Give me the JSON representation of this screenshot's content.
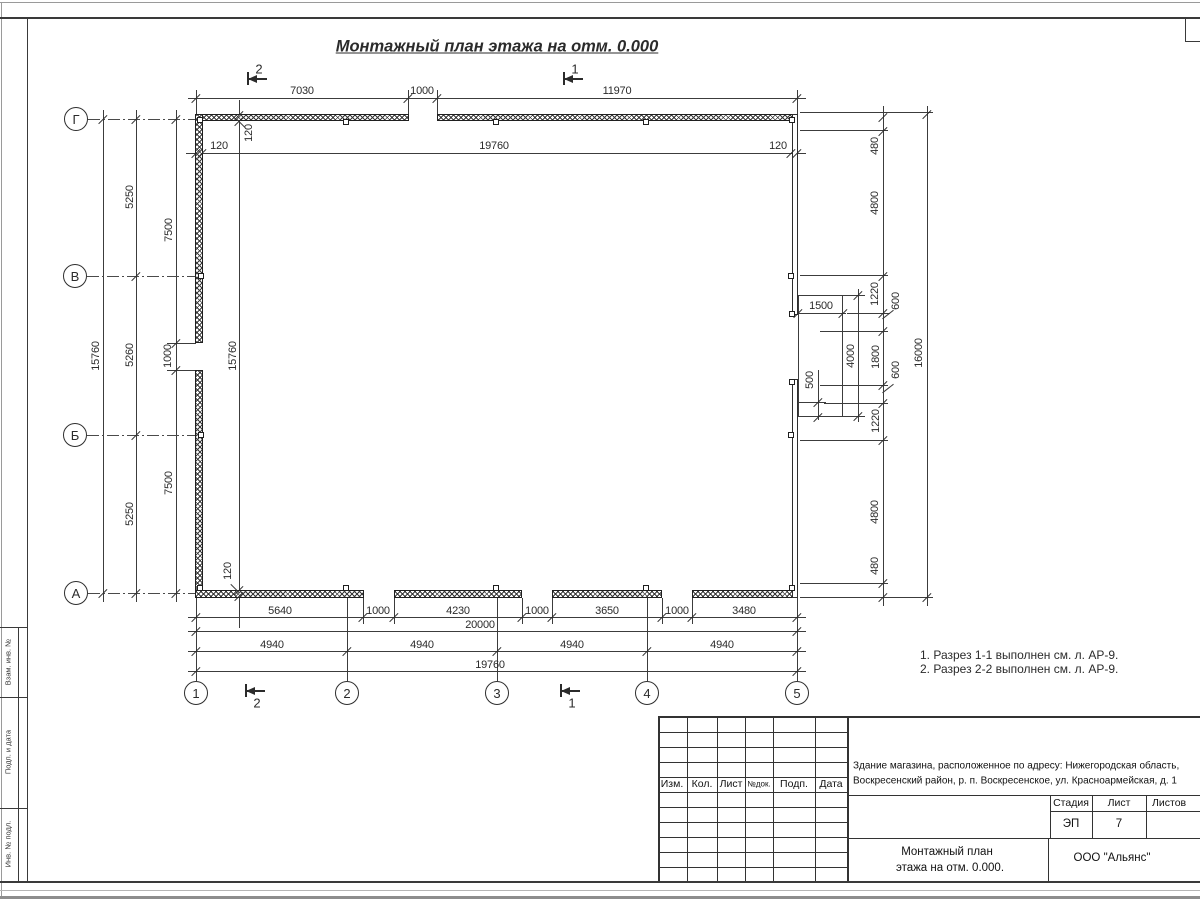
{
  "page": {
    "title": "Монтажный план этажа на отм. 0.000",
    "notes": [
      "1. Разрез 1-1 выполнен см. л. АР-9.",
      "2. Разрез 2-2 выполнен см. л. АР-9."
    ]
  },
  "colors": {
    "line": "#3c3c3c",
    "wall": "#1f1f1f",
    "text": "#2b2b2b"
  },
  "frame": {
    "side_labels": [
      "Взам. инв. №",
      "Подп. и дата",
      "Инв. № подл."
    ]
  },
  "axes": {
    "left": [
      {
        "label": "Г",
        "cx": 76,
        "cy": 119
      },
      {
        "label": "В",
        "cx": 75,
        "cy": 276
      },
      {
        "label": "Б",
        "cx": 75,
        "cy": 435
      },
      {
        "label": "А",
        "cx": 76,
        "cy": 593
      }
    ],
    "bottom": [
      {
        "label": "1",
        "cx": 196,
        "cy": 693
      },
      {
        "label": "2",
        "cx": 347,
        "cy": 693
      },
      {
        "label": "3",
        "cx": 497,
        "cy": 693
      },
      {
        "label": "4",
        "cx": 647,
        "cy": 693
      },
      {
        "label": "5",
        "cx": 797,
        "cy": 693
      }
    ]
  },
  "section_markers": [
    {
      "label": "2",
      "x": 247,
      "y": 78,
      "pos": "top"
    },
    {
      "label": "1",
      "x": 563,
      "y": 78,
      "pos": "top"
    },
    {
      "label": "2",
      "x": 245,
      "y": 690,
      "pos": "bottom"
    },
    {
      "label": "1",
      "x": 560,
      "y": 690,
      "pos": "bottom"
    }
  ],
  "drawing": {
    "walls": [
      [
        195,
        114,
        214,
        7
      ],
      [
        437,
        114,
        361,
        7
      ],
      [
        195,
        114,
        8,
        229
      ],
      [
        195,
        370,
        8,
        228
      ],
      [
        195,
        590,
        169,
        8
      ],
      [
        394,
        590,
        128,
        8
      ],
      [
        552,
        590,
        110,
        8
      ],
      [
        692,
        590,
        106,
        8
      ]
    ],
    "curtain_walls": [
      [
        792,
        114,
        6,
        201
      ],
      [
        792,
        379,
        6,
        219
      ]
    ],
    "porch": [
      798,
      295,
      45,
      122
    ],
    "columns": [
      [
        197,
        117
      ],
      [
        343,
        119
      ],
      [
        493,
        119
      ],
      [
        643,
        119
      ],
      [
        789,
        117
      ],
      [
        197,
        585
      ],
      [
        343,
        585
      ],
      [
        493,
        585
      ],
      [
        643,
        585
      ],
      [
        789,
        585
      ],
      [
        198,
        273
      ],
      [
        198,
        432
      ],
      [
        788,
        273
      ],
      [
        789,
        311
      ],
      [
        789,
        379
      ],
      [
        788,
        432
      ]
    ],
    "lines": [
      [
        0,
        2,
        1200,
        1,
        "#9a9a9a"
      ],
      [
        1,
        2,
        1,
        895,
        "#9a9a9a"
      ],
      [
        0,
        17,
        1200,
        2,
        "#3a3a3a"
      ],
      [
        27,
        17,
        1,
        864,
        "#3a3a3a"
      ],
      [
        18,
        627,
        1,
        254,
        "#3a3a3a"
      ],
      [
        0,
        627,
        27,
        1,
        "#3a3a3a"
      ],
      [
        0,
        697,
        27,
        1,
        "#3a3a3a"
      ],
      [
        0,
        808,
        27,
        1,
        "#3a3a3a"
      ],
      [
        0,
        881,
        1200,
        2,
        "#3a3a3a"
      ],
      [
        0,
        890,
        1200,
        1,
        "#b5b5b5"
      ],
      [
        0,
        896,
        1200,
        3,
        "#8d8d8d"
      ],
      [
        1185,
        18,
        1,
        24,
        "#3a3a3a"
      ],
      [
        1185,
        41,
        15,
        1,
        "#3a3a3a"
      ],
      [
        658,
        716,
        542,
        2,
        "#333"
      ],
      [
        658,
        732,
        189,
        1,
        "#333"
      ],
      [
        658,
        747,
        189,
        1,
        "#333"
      ],
      [
        658,
        762,
        189,
        1,
        "#333"
      ],
      [
        658,
        777,
        189,
        1,
        "#333"
      ],
      [
        658,
        792,
        189,
        1,
        "#333"
      ],
      [
        658,
        807,
        189,
        1,
        "#333"
      ],
      [
        658,
        822,
        189,
        1,
        "#333"
      ],
      [
        658,
        837,
        189,
        1,
        "#333"
      ],
      [
        658,
        852,
        189,
        1,
        "#333"
      ],
      [
        658,
        867,
        189,
        1,
        "#333"
      ],
      [
        658,
        716,
        2,
        165,
        "#333"
      ],
      [
        687,
        717,
        1,
        164,
        "#333"
      ],
      [
        717,
        717,
        1,
        164,
        "#333"
      ],
      [
        745,
        717,
        1,
        164,
        "#333"
      ],
      [
        773,
        717,
        1,
        164,
        "#333"
      ],
      [
        815,
        717,
        1,
        164,
        "#333"
      ],
      [
        847,
        716,
        2,
        165,
        "#333"
      ],
      [
        847,
        795,
        353,
        1,
        "#333"
      ],
      [
        1050,
        811,
        150,
        1,
        "#333"
      ],
      [
        847,
        838,
        353,
        1,
        "#333"
      ],
      [
        1050,
        795,
        1,
        43,
        "#333"
      ],
      [
        1092,
        795,
        1,
        43,
        "#333"
      ],
      [
        1146,
        795,
        1,
        43,
        "#333"
      ],
      [
        1048,
        838,
        1,
        43,
        "#333"
      ],
      [
        188,
        98,
        618,
        1
      ],
      [
        186,
        153,
        620,
        1
      ],
      [
        167,
        343,
        29,
        1
      ],
      [
        167,
        370,
        29,
        1
      ],
      [
        188,
        617,
        618,
        1
      ],
      [
        188,
        631,
        618,
        1
      ],
      [
        188,
        651,
        618,
        1
      ],
      [
        188,
        671,
        618,
        1
      ],
      [
        800,
        112,
        133,
        1
      ],
      [
        800,
        130,
        88,
        1
      ],
      [
        800,
        275,
        88,
        1
      ],
      [
        847,
        313,
        43,
        1
      ],
      [
        820,
        331,
        68,
        1
      ],
      [
        820,
        385,
        68,
        1
      ],
      [
        824,
        403,
        64,
        1
      ],
      [
        800,
        440,
        88,
        1
      ],
      [
        800,
        583,
        88,
        1
      ],
      [
        800,
        597,
        133,
        1
      ],
      [
        795,
        313,
        51,
        1
      ],
      [
        843,
        295,
        22,
        1
      ],
      [
        843,
        416,
        22,
        1
      ],
      [
        798,
        402,
        28,
        1
      ],
      [
        103,
        110,
        1,
        492
      ],
      [
        136,
        110,
        1,
        492
      ],
      [
        176,
        110,
        1,
        492
      ],
      [
        239,
        100,
        1,
        528
      ],
      [
        196,
        90,
        1,
        25
      ],
      [
        408,
        90,
        1,
        25
      ],
      [
        437,
        90,
        1,
        25
      ],
      [
        797,
        90,
        1,
        25
      ],
      [
        883,
        106,
        1,
        500
      ],
      [
        927,
        106,
        1,
        500
      ],
      [
        196,
        598,
        1,
        83
      ],
      [
        347,
        598,
        1,
        83
      ],
      [
        497,
        598,
        1,
        83
      ],
      [
        647,
        598,
        1,
        83
      ],
      [
        797,
        598,
        1,
        83
      ],
      [
        363,
        598,
        1,
        26
      ],
      [
        394,
        598,
        1,
        26
      ],
      [
        522,
        598,
        1,
        26
      ],
      [
        552,
        598,
        1,
        26
      ],
      [
        662,
        598,
        1,
        26
      ],
      [
        692,
        598,
        1,
        26
      ],
      [
        858,
        289,
        1,
        133
      ],
      [
        818,
        370,
        1,
        50
      ]
    ],
    "axis_dashes": [
      [
        88,
        119,
        107
      ],
      [
        87,
        276,
        108
      ],
      [
        87,
        435,
        108
      ],
      [
        88,
        593,
        107
      ]
    ],
    "ticks": [
      [
        196,
        98
      ],
      [
        408,
        98
      ],
      [
        437,
        98
      ],
      [
        797,
        98
      ],
      [
        196,
        153
      ],
      [
        202,
        153
      ],
      [
        791,
        153
      ],
      [
        797,
        153
      ],
      [
        103,
        119
      ],
      [
        103,
        593
      ],
      [
        136,
        119
      ],
      [
        136,
        276
      ],
      [
        136,
        435
      ],
      [
        136,
        593
      ],
      [
        176,
        119
      ],
      [
        176,
        343
      ],
      [
        176,
        370
      ],
      [
        176,
        593
      ],
      [
        239,
        115
      ],
      [
        239,
        121
      ],
      [
        239,
        590
      ],
      [
        239,
        596
      ],
      [
        883,
        117
      ],
      [
        883,
        131
      ],
      [
        883,
        276
      ],
      [
        883,
        313
      ],
      [
        883,
        331
      ],
      [
        883,
        385
      ],
      [
        883,
        403
      ],
      [
        883,
        440
      ],
      [
        883,
        583
      ],
      [
        883,
        597
      ],
      [
        927,
        114
      ],
      [
        927,
        597
      ],
      [
        196,
        617
      ],
      [
        363,
        617
      ],
      [
        394,
        617
      ],
      [
        522,
        617
      ],
      [
        552,
        617
      ],
      [
        662,
        617
      ],
      [
        692,
        617
      ],
      [
        797,
        617
      ],
      [
        196,
        631
      ],
      [
        797,
        631
      ],
      [
        196,
        651
      ],
      [
        347,
        651
      ],
      [
        497,
        651
      ],
      [
        647,
        651
      ],
      [
        797,
        651
      ],
      [
        196,
        671
      ],
      [
        797,
        671
      ],
      [
        798,
        313
      ],
      [
        843,
        313
      ],
      [
        858,
        295
      ],
      [
        858,
        416
      ],
      [
        818,
        402
      ],
      [
        818,
        417
      ]
    ],
    "leaders": [
      [
        241,
        123,
        12,
        45
      ],
      [
        235,
        588,
        12,
        45
      ],
      [
        888,
        314,
        14,
        -38
      ],
      [
        888,
        388,
        14,
        -38
      ]
    ],
    "dim_labels": [
      [
        "7030",
        302,
        91,
        0
      ],
      [
        "1000",
        422,
        91,
        0
      ],
      [
        "11970",
        617,
        91,
        0
      ],
      [
        "120",
        219,
        146,
        0
      ],
      [
        "19760",
        494,
        146,
        0
      ],
      [
        "120",
        778,
        146,
        0
      ],
      [
        "15760",
        96,
        356,
        1
      ],
      [
        "5250",
        130,
        197,
        1
      ],
      [
        "5260",
        130,
        355,
        1
      ],
      [
        "5250",
        130,
        514,
        1
      ],
      [
        "7500",
        169,
        230,
        1
      ],
      [
        "1000",
        168,
        356,
        1
      ],
      [
        "7500",
        169,
        483,
        1
      ],
      [
        "15760",
        233,
        356,
        1
      ],
      [
        "120",
        249,
        133,
        1
      ],
      [
        "120",
        228,
        571,
        1
      ],
      [
        "480",
        875,
        146,
        1
      ],
      [
        "4800",
        875,
        203,
        1
      ],
      [
        "1220",
        875,
        294,
        1
      ],
      [
        "600",
        896,
        301,
        1
      ],
      [
        "1800",
        876,
        357,
        1
      ],
      [
        "600",
        896,
        370,
        1
      ],
      [
        "1220",
        876,
        421,
        1
      ],
      [
        "4800",
        875,
        512,
        1
      ],
      [
        "480",
        875,
        566,
        1
      ],
      [
        "16000",
        919,
        353,
        1
      ],
      [
        "4000",
        851,
        356,
        1
      ],
      [
        "500",
        810,
        380,
        1
      ],
      [
        "1500",
        821,
        306,
        0
      ],
      [
        "5640",
        280,
        611,
        0
      ],
      [
        "1000",
        378,
        611,
        0
      ],
      [
        "4230",
        458,
        611,
        0
      ],
      [
        "1000",
        537,
        611,
        0
      ],
      [
        "3650",
        607,
        611,
        0
      ],
      [
        "1000",
        677,
        611,
        0
      ],
      [
        "3480",
        744,
        611,
        0
      ],
      [
        "20000",
        480,
        625,
        0
      ],
      [
        "4940",
        272,
        645,
        0
      ],
      [
        "4940",
        422,
        645,
        0
      ],
      [
        "4940",
        572,
        645,
        0
      ],
      [
        "4940",
        722,
        645,
        0
      ],
      [
        "19760",
        490,
        665,
        0
      ]
    ]
  },
  "title_block": {
    "header_cols": [
      "Изм.",
      "Кол.",
      "Лист",
      "№док.",
      "Подп.",
      "Дата"
    ],
    "address_line1": "Здание магазина, расположенное по адресу: Нижегородская область,",
    "address_line2": "Воскресенский район, р. п. Воскресенское, ул. Красноармейская, д. 1",
    "stage_label": "Стадия",
    "sheet_label": "Лист",
    "sheets_label": "Листов",
    "stage_value": "ЭП",
    "sheet_value": "7",
    "doc_title_line1": "Монтажный план",
    "doc_title_line2": "этажа на отм. 0.000.",
    "company": "ООО \"Альянс\""
  }
}
